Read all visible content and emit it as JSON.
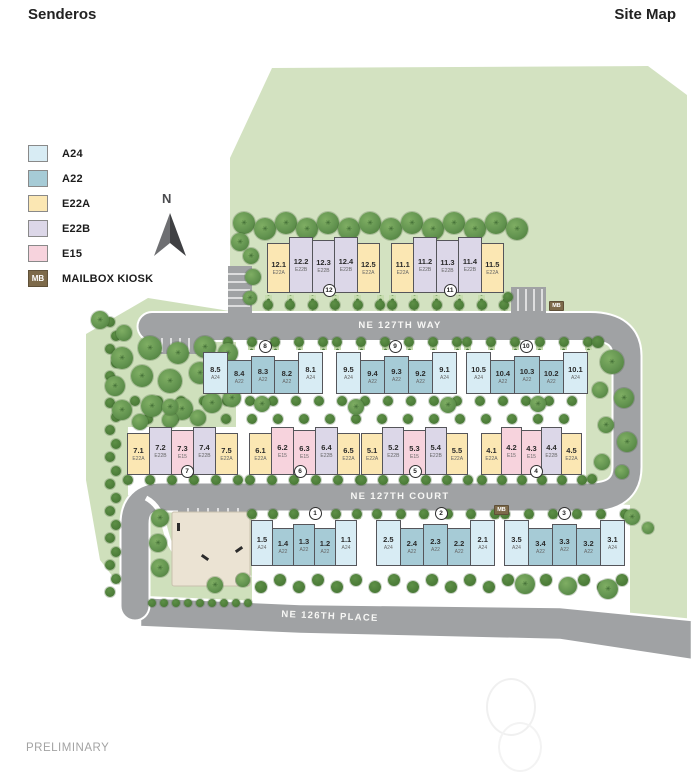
{
  "header": {
    "title": "Senderos",
    "page_label": "Site Map"
  },
  "legend": {
    "items": [
      {
        "code": "A24",
        "color": "#d8ecf4"
      },
      {
        "code": "A22",
        "color": "#a6cbd6"
      },
      {
        "code": "E22A",
        "color": "#fbe7b3"
      },
      {
        "code": "E22B",
        "color": "#dcd7e8"
      },
      {
        "code": "E15",
        "color": "#f7d3dd"
      }
    ],
    "mailbox": {
      "abbr": "MB",
      "label": "MAILBOX KIOSK",
      "color": "#7d6a4a"
    }
  },
  "compass_label": "N",
  "labels": {
    "open_space": "COMMUNITY OPEN SPACE",
    "park": "PRIVATE PARK"
  },
  "streets": {
    "way": "NE 127TH WAY",
    "court": "NE 127TH COURT",
    "place": "NE 126TH PLACE"
  },
  "mailbox_markers": [
    {
      "abbr": "MB"
    },
    {
      "abbr": "MB"
    }
  ],
  "buildings": [
    {
      "id": "12",
      "units": [
        {
          "num": "12.1",
          "type": "E22A"
        },
        {
          "num": "12.2",
          "type": "E22B"
        },
        {
          "num": "12.3",
          "type": "E22B"
        },
        {
          "num": "12.4",
          "type": "E22B"
        },
        {
          "num": "12.5",
          "type": "E22A"
        }
      ]
    },
    {
      "id": "11",
      "units": [
        {
          "num": "11.1",
          "type": "E22A"
        },
        {
          "num": "11.2",
          "type": "E22B"
        },
        {
          "num": "11.3",
          "type": "E22B"
        },
        {
          "num": "11.4",
          "type": "E22B"
        },
        {
          "num": "11.5",
          "type": "E22A"
        }
      ]
    },
    {
      "id": "8",
      "units": [
        {
          "num": "8.5",
          "type": "A24"
        },
        {
          "num": "8.4",
          "type": "A22"
        },
        {
          "num": "8.3",
          "type": "A22"
        },
        {
          "num": "8.2",
          "type": "A22"
        },
        {
          "num": "8.1",
          "type": "A24"
        }
      ]
    },
    {
      "id": "9",
      "units": [
        {
          "num": "9.5",
          "type": "A24"
        },
        {
          "num": "9.4",
          "type": "A22"
        },
        {
          "num": "9.3",
          "type": "A22"
        },
        {
          "num": "9.2",
          "type": "A22"
        },
        {
          "num": "9.1",
          "type": "A24"
        }
      ]
    },
    {
      "id": "10",
      "units": [
        {
          "num": "10.5",
          "type": "A24"
        },
        {
          "num": "10.4",
          "type": "A22"
        },
        {
          "num": "10.3",
          "type": "A22"
        },
        {
          "num": "10.2",
          "type": "A22"
        },
        {
          "num": "10.1",
          "type": "A24"
        }
      ]
    },
    {
      "id": "7",
      "units": [
        {
          "num": "7.1",
          "type": "E22A"
        },
        {
          "num": "7.2",
          "type": "E22B"
        },
        {
          "num": "7.3",
          "type": "E15"
        },
        {
          "num": "7.4",
          "type": "E22B"
        },
        {
          "num": "7.5",
          "type": "E22A"
        }
      ]
    },
    {
      "id": "6",
      "units": [
        {
          "num": "6.1",
          "type": "E22A"
        },
        {
          "num": "6.2",
          "type": "E15"
        },
        {
          "num": "6.3",
          "type": "E15"
        },
        {
          "num": "6.4",
          "type": "E22B"
        },
        {
          "num": "6.5",
          "type": "E22A"
        }
      ]
    },
    {
      "id": "5",
      "units": [
        {
          "num": "5.1",
          "type": "E22A"
        },
        {
          "num": "5.2",
          "type": "E22B"
        },
        {
          "num": "5.3",
          "type": "E15"
        },
        {
          "num": "5.4",
          "type": "E22B"
        },
        {
          "num": "5.5",
          "type": "E22A"
        }
      ]
    },
    {
      "id": "4",
      "units": [
        {
          "num": "4.1",
          "type": "E22A"
        },
        {
          "num": "4.2",
          "type": "E15"
        },
        {
          "num": "4.3",
          "type": "E15"
        },
        {
          "num": "4.4",
          "type": "E22B"
        },
        {
          "num": "4.5",
          "type": "E22A"
        }
      ]
    },
    {
      "id": "1",
      "units": [
        {
          "num": "1.5",
          "type": "A24"
        },
        {
          "num": "1.4",
          "type": "A22"
        },
        {
          "num": "1.3",
          "type": "A22"
        },
        {
          "num": "1.2",
          "type": "A22"
        },
        {
          "num": "1.1",
          "type": "A24"
        }
      ]
    },
    {
      "id": "2",
      "units": [
        {
          "num": "2.5",
          "type": "A24"
        },
        {
          "num": "2.4",
          "type": "A22"
        },
        {
          "num": "2.3",
          "type": "A22"
        },
        {
          "num": "2.2",
          "type": "A22"
        },
        {
          "num": "2.1",
          "type": "A24"
        }
      ]
    },
    {
      "id": "3",
      "units": [
        {
          "num": "3.5",
          "type": "A24"
        },
        {
          "num": "3.4",
          "type": "A22"
        },
        {
          "num": "3.3",
          "type": "A22"
        },
        {
          "num": "3.2",
          "type": "A22"
        },
        {
          "num": "3.1",
          "type": "A24"
        }
      ]
    }
  ],
  "footer": {
    "status": "PRELIMINARY"
  },
  "palette": {
    "road": "#a0a2a4",
    "open_space": "#d3e2c1",
    "park_pad": "#ebe3d3"
  }
}
